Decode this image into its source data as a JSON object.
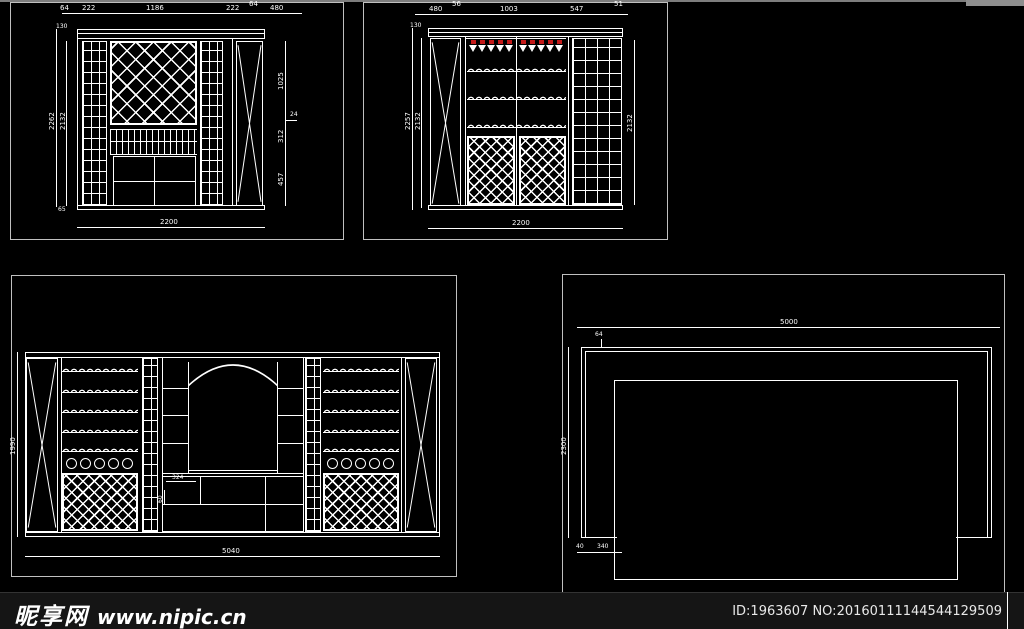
{
  "footer": {
    "site_name": "昵享网",
    "site_url": "www.nipic.cn",
    "id_text": "ID:1963607 NO:20160111144544129509"
  },
  "d1": {
    "title": "wine-cabinet-elevation-A",
    "dims_top": [
      "64",
      "222",
      "1186",
      "222",
      "64",
      "480"
    ],
    "dim_left_outer": "2262",
    "dim_left_inner": "2132",
    "dim_left_top": "130",
    "dim_left_bottom": "65",
    "dims_right": [
      "1025",
      "24",
      "312",
      "457"
    ],
    "dim_bottom": "2200"
  },
  "d2": {
    "title": "wine-cabinet-elevation-B",
    "dims_top": [
      "480",
      "56",
      "1003",
      "547",
      "51"
    ],
    "dim_left_outer": "2257",
    "dim_left_inner": "2132",
    "dim_left_top": "130",
    "dim_right": "2132",
    "dim_bottom": "2200"
  },
  "d3": {
    "title": "wine-wall-elevation-wide",
    "dim_left": "1990",
    "dim_bottom": "5040",
    "dim_counter_w": "324",
    "dim_counter_h": "60"
  },
  "d4": {
    "title": "plan-view",
    "dim_top": "5000",
    "dim_offset": "64",
    "dim_left": "2300",
    "dims_bottom": [
      "40",
      "340"
    ]
  },
  "colors": {
    "line": "#ffffff",
    "wine_red": "#c41a1a",
    "viewport_border": "#c0c0c0",
    "footer_bg": "#151515",
    "background": "#000000"
  }
}
